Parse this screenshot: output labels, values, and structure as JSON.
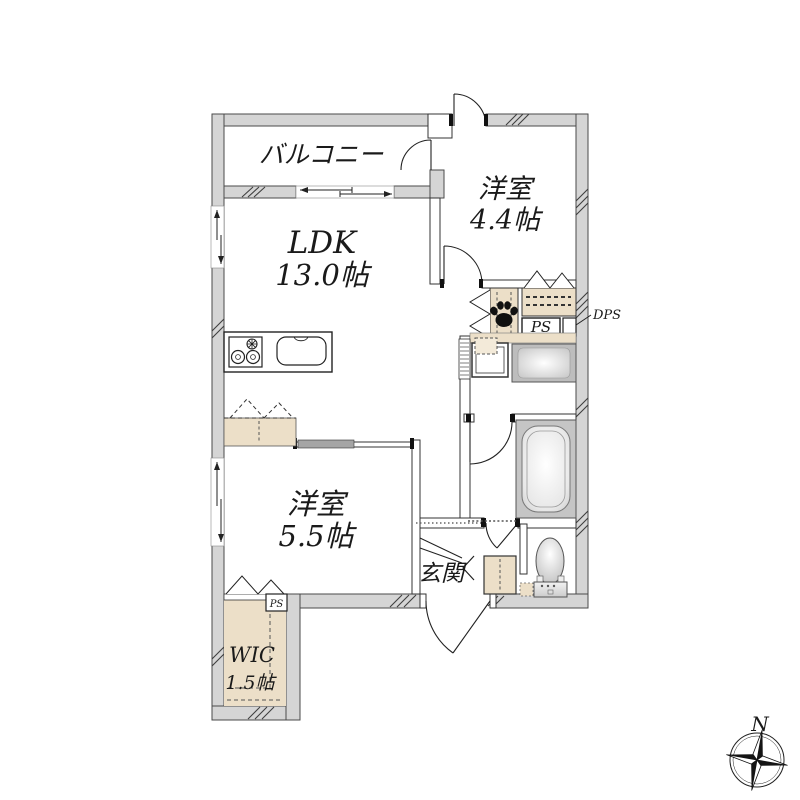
{
  "rooms": {
    "balcony": {
      "name": "バルコニー"
    },
    "bedroom_44": {
      "name": "洋室",
      "size": "4.4帖"
    },
    "ldk": {
      "name": "LDK",
      "size": "13.0帖"
    },
    "bedroom_55": {
      "name": "洋室",
      "size": "5.5帖"
    },
    "wic": {
      "name": "WIC",
      "size": "1.5帖"
    },
    "entrance": {
      "name": "玄関"
    }
  },
  "labels": {
    "ps_hall": "PS",
    "ps_wic": "PS",
    "dps": "DPS",
    "compass_north": "N"
  },
  "colors": {
    "background": "#ffffff",
    "wall_fill": "#d5d5d5",
    "wall_stroke": "#4a4a4a",
    "closet_fill": "#ecdfc8",
    "fixture_gray": "#c5c5c5",
    "ink": "#1a1a1a"
  }
}
